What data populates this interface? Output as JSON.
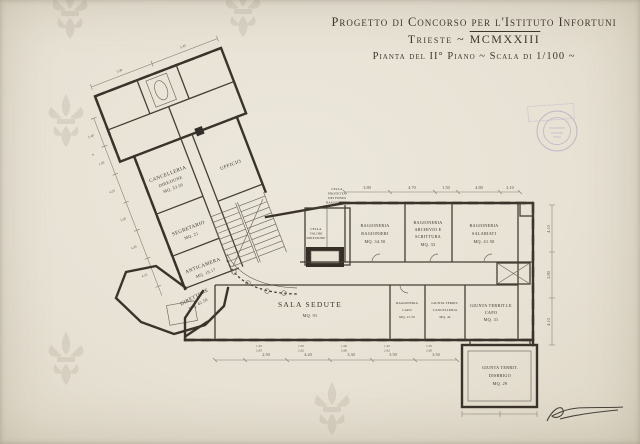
{
  "title": {
    "line1": "Progetto di Concorso per l'Istituto Infortuni",
    "line2_city": "Trieste ~",
    "line2_year": "MCMXXIII",
    "line3": "Pianta del II° Piano ~ Scala di 1/100 ~"
  },
  "rooms": {
    "cancelleria": [
      "CANCELLERIA",
      "DIREZIONE",
      "MQ. 23.50"
    ],
    "segretario": [
      "SEGRETARIO",
      "MQ. 21"
    ],
    "anticamera": [
      "ANTICAMERA",
      "MQ. 19.17"
    ],
    "ufficio": [
      "UFFICIO"
    ],
    "direttore": [
      "DIRETTORE",
      "MQ. 42.50"
    ],
    "sala_sedute": [
      "SALA SEDUTE",
      "MQ. 91"
    ],
    "rag_ragionieri": [
      "RAGIONERIA",
      "RAGIONIERI",
      "MQ. 34.50"
    ],
    "rag_archivio": [
      "RAGIONERIA",
      "ARCHIVIO E",
      "SCRITTURA",
      "MQ. 33"
    ],
    "rag_salariati": [
      "RAGIONERIA",
      "SALARIATI",
      "MQ. 41.50"
    ],
    "rag_capo": [
      "RAGIONERIA",
      "CAPO",
      "MQ. 15.50"
    ],
    "giunta_cancelleria": [
      "GIUNTA TERRIT.",
      "CANCELLERIA",
      "MQ. 44"
    ],
    "giunta_capo": [
      "GIUNTA TERRIT.LE",
      "CAPO",
      "MQ. 31"
    ],
    "giunta_disbrigo": [
      "GIUNTA TERRIT.",
      "DISBRIGO",
      "MQ. 29"
    ],
    "cella_protetta": [
      "CELLA",
      "PROTETTA",
      "DEI FONDI",
      "RAGIONERIA"
    ],
    "cella_valori": [
      "CELLA",
      "VALORI",
      "DIREZIONE"
    ]
  },
  "dims": {
    "top": [
      "3.80",
      "4.70",
      "1.50",
      "4.80",
      "2.10"
    ],
    "bottom": [
      "2.50",
      "4.20",
      "3.30",
      "3.50",
      "3.50"
    ],
    "bottom_pairs": [
      [
        "1.45",
        "2.65"
      ],
      [
        "1.05",
        "2.62"
      ],
      [
        "1.06",
        "2.60"
      ],
      [
        "1.45",
        "2.62"
      ],
      [
        "1.05",
        "2.60"
      ]
    ],
    "right": [
      "4.10",
      "2.80",
      "4.10"
    ],
    "left_wing": [
      "5.40",
      "1.50",
      "4.25",
      "1.50",
      "4.30",
      "4.35"
    ],
    "top_left": [
      "5.40",
      "5.45"
    ]
  },
  "marks": {
    "star": "*"
  },
  "colors": {
    "paper": "#e9e3d6",
    "ink": "#39332b",
    "stamp": "#7b72b5",
    "watermark": "#857a64"
  }
}
